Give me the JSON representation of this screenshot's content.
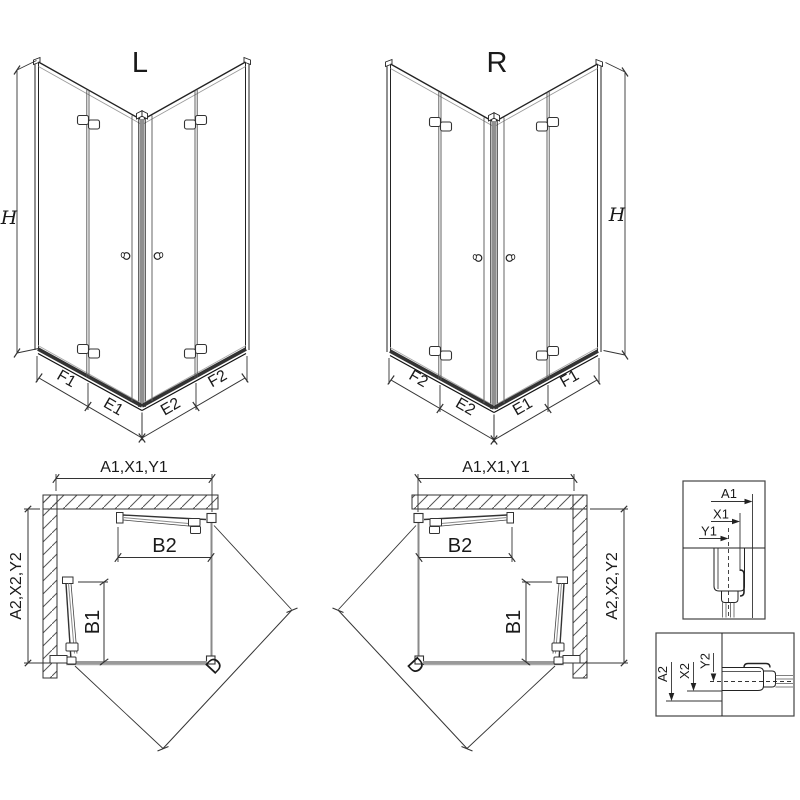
{
  "drawing": {
    "variant_left": {
      "title": "L",
      "height_dim": "H",
      "bottom_dims": [
        "F1",
        "E1",
        "E2",
        "F2"
      ]
    },
    "variant_right": {
      "title": "R",
      "height_dim": "H",
      "bottom_dims": [
        "F2",
        "E2",
        "E1",
        "F1"
      ]
    },
    "plan_left": {
      "width_dim": "A1,X1,Y1",
      "depth_dim": "A2,X2,Y2",
      "door_top": "B2",
      "door_side": "B1",
      "diagonal_dim": "D"
    },
    "plan_right": {
      "width_dim": "A1,X1,Y1",
      "depth_dim": "A2,X2,Y2",
      "door_top": "B2",
      "door_side": "B1",
      "diagonal_dim": "D"
    },
    "detail_wall_profile_top": {
      "dims": [
        "A1",
        "X1",
        "Y1"
      ]
    },
    "detail_wall_profile_bottom": {
      "dims": [
        "A2",
        "X2",
        "Y2"
      ]
    },
    "colors": {
      "line": "#222222",
      "glass": "#8a8a8a",
      "rail": "#2a2a2a",
      "hatch": "#555555",
      "background": "#ffffff"
    }
  }
}
